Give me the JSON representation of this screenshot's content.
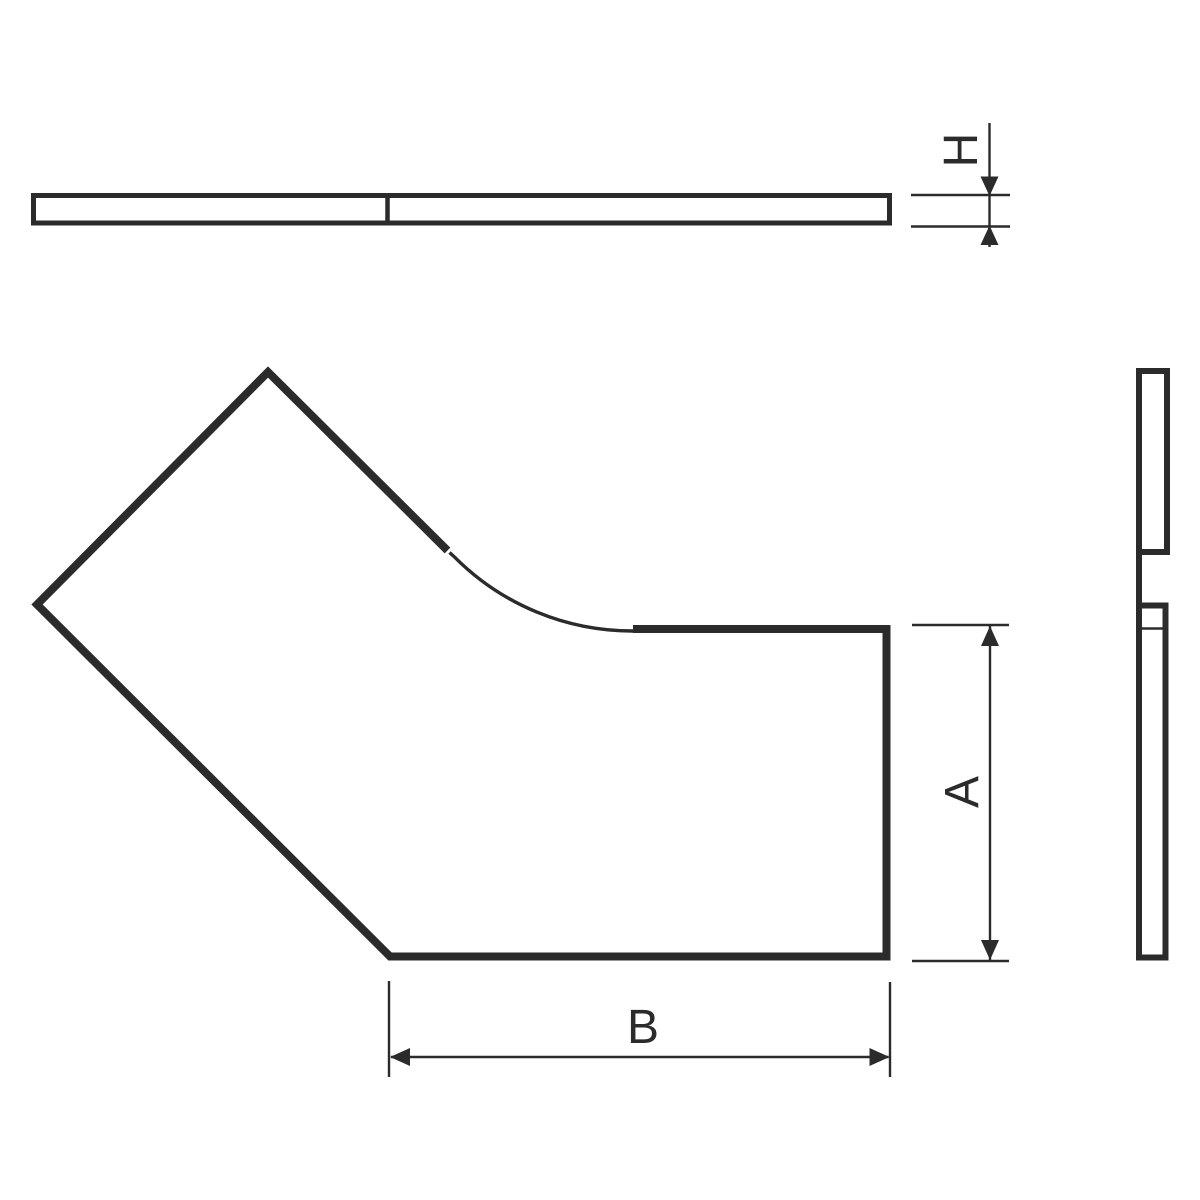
{
  "drawing": {
    "type": "technical-drawing-cable-tray-45-degree-bend-cover",
    "labels": {
      "h": "H",
      "a": "A",
      "b": "B"
    },
    "colors": {
      "line": "#2b2b2b",
      "background": "#ffffff"
    }
  }
}
